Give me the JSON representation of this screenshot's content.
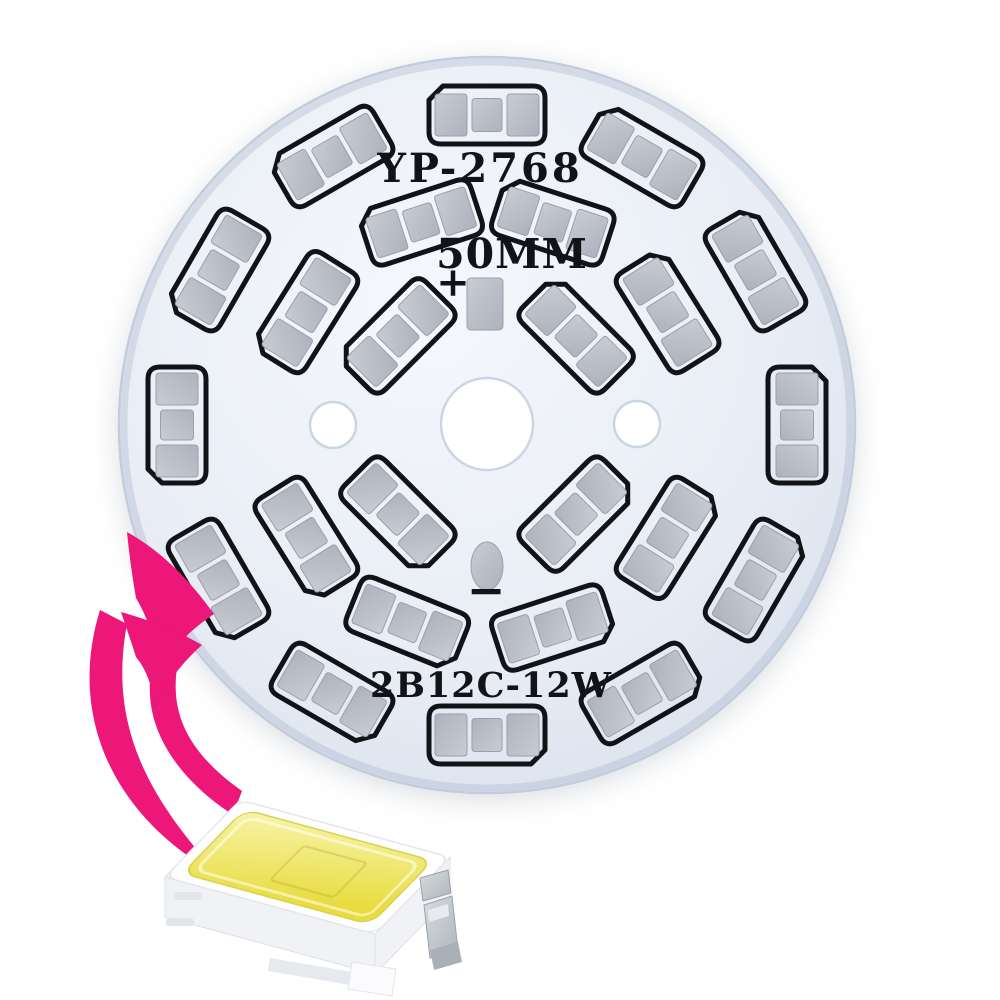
{
  "product": {
    "description": "Round aluminum LED PCB plate with SMD 5730 LED footprints and callout arrow to an SMD LED chip",
    "board": {
      "model_label": "YP-2768",
      "size_label": "50MM",
      "positive_label": "+",
      "negative_label": "−",
      "spec_label": "2B12C-12W",
      "led_count": 24,
      "center": {
        "x": 487,
        "y": 425
      },
      "radius": 368,
      "holes": [
        {
          "name": "center-hole",
          "x": 487,
          "y": 424,
          "r": 46
        },
        {
          "name": "left-mounting-hole",
          "x": 333,
          "y": 425,
          "r": 23
        },
        {
          "name": "right-mounting-hole",
          "x": 637,
          "y": 424,
          "r": 23
        }
      ],
      "solder_pads": {
        "positive": {
          "x": 467,
          "y": 278,
          "w": 36,
          "h": 52
        },
        "negative": {
          "cx": 487,
          "cy": 566,
          "rx": 16,
          "ry": 24
        }
      },
      "led_footprint": {
        "length": 116,
        "width": 58,
        "outline_width": 5,
        "end_pad": {
          "w": 32,
          "h": 42,
          "offset": 36
        },
        "mid_pad": {
          "w": 30,
          "h": 33
        }
      },
      "rings": [
        {
          "name": "outer",
          "radius": 310,
          "angles": [
            0,
            30,
            60,
            90,
            120,
            150,
            180,
            210,
            240,
            270,
            300,
            330
          ]
        },
        {
          "name": "middle",
          "radius": 213,
          "angles": [
            32,
            72,
            108,
            148,
            212,
            248,
            288,
            328
          ]
        },
        {
          "name": "inner",
          "radius": 126,
          "angles": [
            45,
            135,
            225,
            315
          ]
        }
      ],
      "colors": {
        "surface_light": "#f5f8fc",
        "surface_mid": "#e9eef6",
        "surface_edge": "#dbe2ee",
        "edge_stroke": "#c2ccda",
        "rim_shade": "rgba(150,165,190,0.28)",
        "hole_ring": "#ccd5e1",
        "silkscreen": "#111318",
        "pad_light": "#c8ccd4",
        "pad_dark": "#adb2bc",
        "pad_edge": "#9aa0ab"
      }
    },
    "arrow": {
      "name": "callout-arrow",
      "style": "double curved swoosh with two chevron heads",
      "color": "#ec1778"
    },
    "chip": {
      "name": "SMD LED chip",
      "body_color": "#ffffff",
      "body_edge": "#e2e5ea",
      "side_color": "#f0f2f5",
      "phosphor_light": "#f8f4ab",
      "phosphor_dark": "#e8dc3e",
      "phosphor_edge": "#d9d04f",
      "lead_light": "#d8dcdf",
      "lead_dark": "#aeb4bb"
    }
  }
}
